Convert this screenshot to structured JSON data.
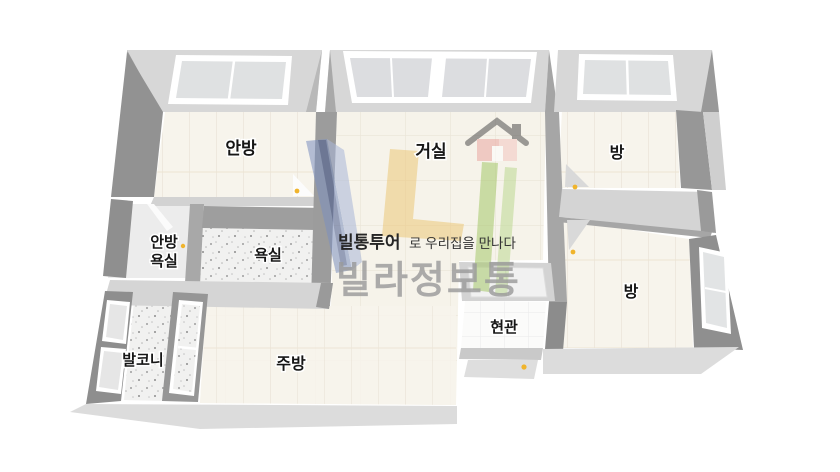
{
  "canvas": {
    "width": 840,
    "height": 472,
    "background": "#ffffff"
  },
  "rooms": [
    {
      "id": "anbang",
      "label": "안방"
    },
    {
      "id": "geosil",
      "label": "거실"
    },
    {
      "id": "bang-top",
      "label": "방"
    },
    {
      "id": "anbang-yoksil",
      "label": "안방욕실",
      "label_line1": "안방",
      "label_line2": "욕실"
    },
    {
      "id": "yoksil",
      "label": "욕실"
    },
    {
      "id": "bang-bottom",
      "label": "방"
    },
    {
      "id": "balkoni",
      "label": "발코니"
    },
    {
      "id": "jubang",
      "label": "주방"
    },
    {
      "id": "hyeongwan",
      "label": "현관"
    }
  ],
  "watermark": {
    "tagline_bold": "빌통투어",
    "tagline_rest": "로 우리집을 만나다",
    "brand": "빌라정보통"
  },
  "palette": {
    "wall_light": "#d7d7d7",
    "wall_dark": "#929292",
    "floor_cream": "#f6f3ea",
    "floor_tile_line": "#eae4d7",
    "bath_speckle": "#f1f1f0",
    "window_glass": "#dfe1e2",
    "door_hinge_yellow": "#f0b42c",
    "logo_blue": "#7c90c0",
    "logo_yellow": "#ecc878",
    "logo_green": "#a6c86a",
    "logo_house_red": "#eba8a2",
    "brand_gray": "#9b9b9b"
  }
}
